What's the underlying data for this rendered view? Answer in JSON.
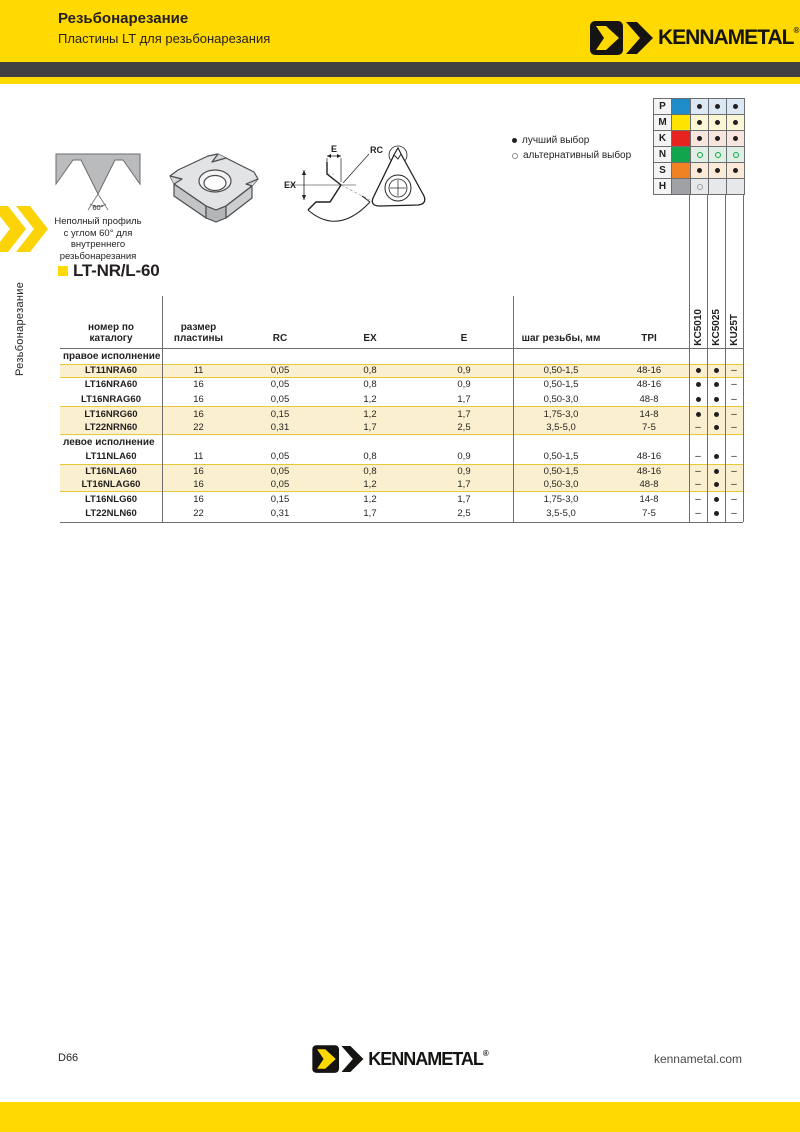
{
  "header": {
    "title": "Резьбонарезание",
    "subtitle": "Пластины LT для резьбонарезания",
    "brand": "KENNAMETAL"
  },
  "sidebar": {
    "vertical_label": "Резьбонарезание"
  },
  "legend": {
    "best": "лучший выбор",
    "alternative": "альтернативный выбор"
  },
  "grade_chart": {
    "materials": [
      {
        "letter": "P",
        "color": "#1f8cca",
        "tint": "#dce8f3",
        "dots": [
          "best",
          "best",
          "best"
        ]
      },
      {
        "letter": "M",
        "color": "#ffe400",
        "tint": "#fbf6d4",
        "dots": [
          "best",
          "best",
          "best"
        ]
      },
      {
        "letter": "K",
        "color": "#e6231f",
        "tint": "#f8e5dd",
        "dots": [
          "best",
          "best",
          "best"
        ]
      },
      {
        "letter": "N",
        "color": "#11a64e",
        "tint": "#e0efe3",
        "dots": [
          "alt",
          "alt",
          "alt"
        ]
      },
      {
        "letter": "S",
        "color": "#f08223",
        "tint": "#fcead9",
        "dots": [
          "best",
          "best",
          "best"
        ]
      },
      {
        "letter": "H",
        "color": "#9fa1a4",
        "tint": "#e7e8e9",
        "dots": [
          "alt",
          "empty",
          "empty"
        ]
      }
    ]
  },
  "product": {
    "code": "LT-NR/L-60",
    "description_lines": [
      "Неполный профиль",
      "с углом 60° для",
      "внутреннего",
      "резьбонарезания"
    ],
    "profile_angle": "60°"
  },
  "diagram_labels": {
    "e": "E",
    "rc": "RC",
    "ex": "EX"
  },
  "table": {
    "headers": {
      "catalog": [
        "номер по",
        "каталогу"
      ],
      "size": [
        "размер",
        "пластины"
      ],
      "rc": "RC",
      "ex": "EX",
      "e": "E",
      "pitch": "шаг резьбы, мм",
      "tpi": "TPI",
      "grades": [
        "KC5010",
        "KC5025",
        "KU25T"
      ]
    },
    "sections": [
      {
        "label": "правое исполнение",
        "rows": [
          {
            "catalog": "LT11NRA60",
            "size": "11",
            "rc": "0,05",
            "ex": "0,8",
            "e": "0,9",
            "pitch": "0,50-1,5",
            "tpi": "48-16",
            "grades": [
              "best",
              "best",
              "none"
            ],
            "shaded": true
          },
          {
            "catalog": "LT16NRA60",
            "size": "16",
            "rc": "0,05",
            "ex": "0,8",
            "e": "0,9",
            "pitch": "0,50-1,5",
            "tpi": "48-16",
            "grades": [
              "best",
              "best",
              "none"
            ],
            "shaded": false
          },
          {
            "catalog": "LT16NRAG60",
            "size": "16",
            "rc": "0,05",
            "ex": "1,2",
            "e": "1,7",
            "pitch": "0,50-3,0",
            "tpi": "48-8",
            "grades": [
              "best",
              "best",
              "none"
            ],
            "shaded": false
          },
          {
            "catalog": "LT16NRG60",
            "size": "16",
            "rc": "0,15",
            "ex": "1,2",
            "e": "1,7",
            "pitch": "1,75-3,0",
            "tpi": "14-8",
            "grades": [
              "best",
              "best",
              "none"
            ],
            "shaded": true
          },
          {
            "catalog": "LT22NRN60",
            "size": "22",
            "rc": "0,31",
            "ex": "1,7",
            "e": "2,5",
            "pitch": "3,5-5,0",
            "tpi": "7-5",
            "grades": [
              "none",
              "best",
              "none"
            ],
            "shaded": true
          }
        ]
      },
      {
        "label": "левое исполнение",
        "rows": [
          {
            "catalog": "LT11NLA60",
            "size": "11",
            "rc": "0,05",
            "ex": "0,8",
            "e": "0,9",
            "pitch": "0,50-1,5",
            "tpi": "48-16",
            "grades": [
              "none",
              "best",
              "none"
            ],
            "shaded": false
          },
          {
            "catalog": "LT16NLA60",
            "size": "16",
            "rc": "0,05",
            "ex": "0,8",
            "e": "0,9",
            "pitch": "0,50-1,5",
            "tpi": "48-16",
            "grades": [
              "none",
              "best",
              "none"
            ],
            "shaded": true
          },
          {
            "catalog": "LT16NLAG60",
            "size": "16",
            "rc": "0,05",
            "ex": "1,2",
            "e": "1,7",
            "pitch": "0,50-3,0",
            "tpi": "48-8",
            "grades": [
              "none",
              "best",
              "none"
            ],
            "shaded": true
          },
          {
            "catalog": "LT16NLG60",
            "size": "16",
            "rc": "0,15",
            "ex": "1,2",
            "e": "1,7",
            "pitch": "1,75-3,0",
            "tpi": "14-8",
            "grades": [
              "none",
              "best",
              "none"
            ],
            "shaded": false
          },
          {
            "catalog": "LT22NLN60",
            "size": "22",
            "rc": "0,31",
            "ex": "1,7",
            "e": "2,5",
            "pitch": "3,5-5,0",
            "tpi": "7-5",
            "grades": [
              "none",
              "best",
              "none"
            ],
            "shaded": false
          }
        ]
      }
    ]
  },
  "footer": {
    "page_number": "D66",
    "website": "kennametal.com",
    "brand": "KENNAMETAL"
  }
}
